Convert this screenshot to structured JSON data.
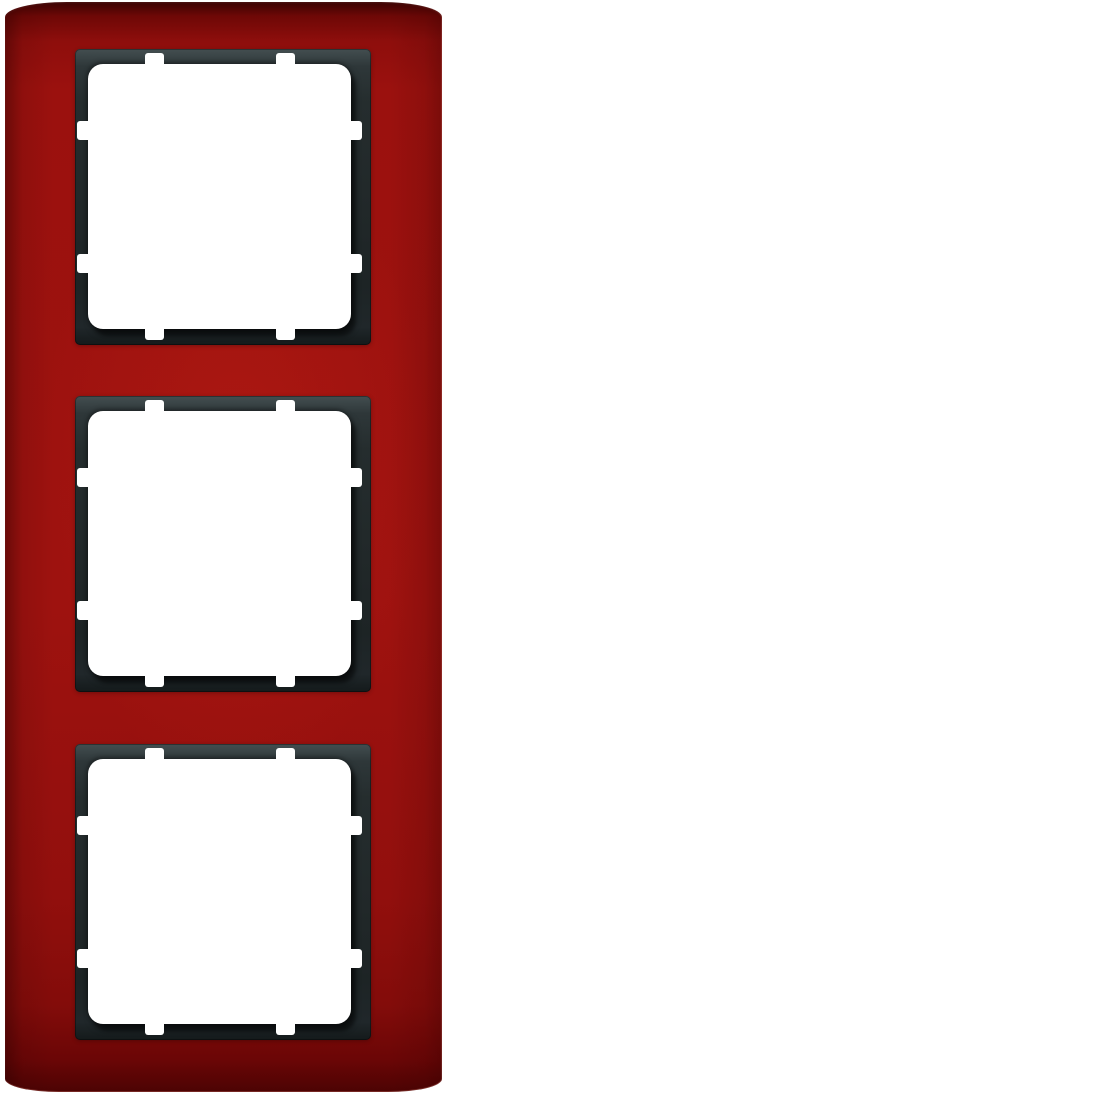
{
  "scene": {
    "description": "Red triple cover frame for flush-mounted switches, portrait orientation, with anthracite inner frames and three empty white module openings",
    "background_color": "#ffffff",
    "plate": {
      "name": "3-gang red cover frame",
      "color_main": "#9b110e",
      "color_highlight": "#9e120f",
      "color_top_edge_dark": "#3a0202",
      "color_bottom_edge_dark": "#6b0606"
    },
    "inner_frame": {
      "name": "anthracite intermediate frame",
      "color_main": "#212829",
      "color_light_edge": "#434e50",
      "color_shadow": "#141a1b"
    },
    "opening": {
      "color": "#ffffff",
      "fixing_tabs_per_side": 2,
      "sides": [
        "top",
        "bottom",
        "left",
        "right"
      ]
    },
    "modules": [
      {
        "id": "module-1",
        "position": "top"
      },
      {
        "id": "module-2",
        "position": "middle"
      },
      {
        "id": "module-3",
        "position": "bottom"
      }
    ]
  }
}
